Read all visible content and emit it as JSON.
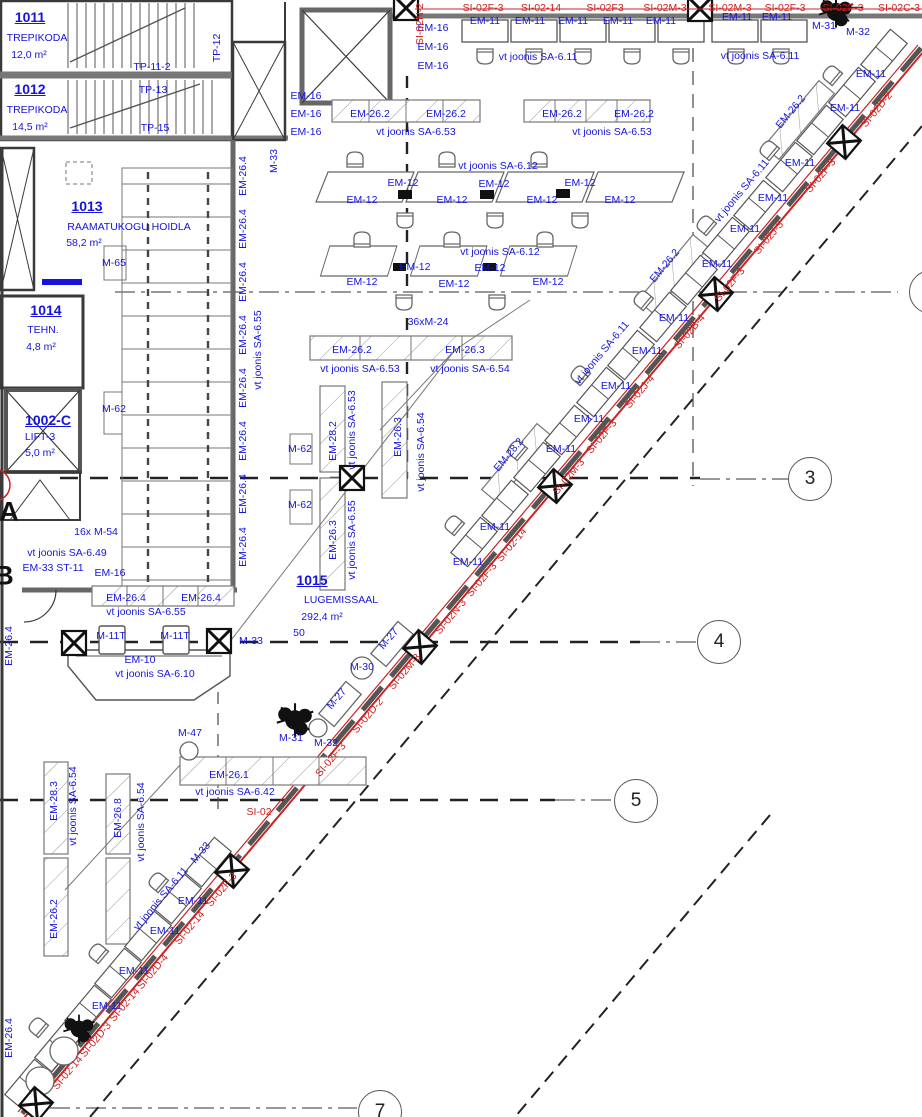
{
  "colors": {
    "label_blue": "#1414dd",
    "annotation_red": "#cc2222",
    "wall_dark": "#3a3a3a",
    "furniture_grey": "#666"
  },
  "grid": {
    "bubbles": [
      {
        "label": "3",
        "x": 810,
        "y": 479
      },
      {
        "label": "4",
        "x": 719,
        "y": 642
      },
      {
        "label": "5",
        "x": 636,
        "y": 801
      },
      {
        "label": "7",
        "x": 380,
        "y": 1112
      },
      {
        "label": "",
        "x": 931,
        "y": 292
      }
    ],
    "letters": [
      {
        "label": "A",
        "x": 9,
        "y": 512
      },
      {
        "label": "B",
        "x": 4,
        "y": 576
      }
    ]
  },
  "labels": [
    {
      "t": "1011",
      "x": 30,
      "y": 17,
      "s": 14,
      "b": 1,
      "u": 1,
      "name": "room-number-1011"
    },
    {
      "t": "TREPIKODA",
      "x": 37,
      "y": 38,
      "name": "room-name-1011"
    },
    {
      "t": "12,0 m²",
      "x": 29,
      "y": 55
    },
    {
      "t": "1012",
      "x": 30,
      "y": 89,
      "s": 14,
      "b": 1,
      "u": 1,
      "name": "room-number-1012"
    },
    {
      "t": "TREPIKODA",
      "x": 37,
      "y": 110,
      "name": "room-name-1012"
    },
    {
      "t": "14,5 m²",
      "x": 30,
      "y": 127
    },
    {
      "t": "TP-11-2",
      "x": 152,
      "y": 67
    },
    {
      "t": "TP-13",
      "x": 153,
      "y": 90
    },
    {
      "t": "TP-15",
      "x": 155,
      "y": 128
    },
    {
      "t": "TP-12",
      "x": 217,
      "y": 48,
      "r": -90
    },
    {
      "t": "M-33",
      "x": 274,
      "y": 161,
      "r": -90
    },
    {
      "t": "1013",
      "x": 87,
      "y": 206,
      "s": 14,
      "b": 1,
      "u": 1,
      "name": "room-number-1013"
    },
    {
      "t": "RAAMATUKOGU HOIDLA",
      "x": 129,
      "y": 227,
      "name": "room-name-1013"
    },
    {
      "t": "58,2 m²",
      "x": 84,
      "y": 243
    },
    {
      "t": "1014",
      "x": 46,
      "y": 310,
      "s": 14,
      "b": 1,
      "u": 1,
      "name": "room-number-1014"
    },
    {
      "t": "TEHN.",
      "x": 43,
      "y": 330,
      "name": "room-name-1014"
    },
    {
      "t": "4,8 m²",
      "x": 41,
      "y": 347
    },
    {
      "t": "1002-C",
      "x": 48,
      "y": 420,
      "s": 14,
      "b": 1,
      "u": 1,
      "name": "room-number-1002c"
    },
    {
      "t": "LIFT-3",
      "x": 40,
      "y": 437,
      "name": "room-name-1002c"
    },
    {
      "t": "5,0 m²",
      "x": 40,
      "y": 453
    },
    {
      "t": "1015",
      "x": 312,
      "y": 580,
      "s": 14,
      "b": 1,
      "u": 1,
      "name": "room-number-1015"
    },
    {
      "t": "LUGEMISSAAL",
      "x": 341,
      "y": 600,
      "name": "room-name-1015"
    },
    {
      "t": "292,4 m²",
      "x": 322,
      "y": 617
    },
    {
      "t": "50",
      "x": 299,
      "y": 633
    },
    {
      "t": "EM-16",
      "x": 433,
      "y": 28
    },
    {
      "t": "EM-16",
      "x": 433,
      "y": 47
    },
    {
      "t": "EM-16",
      "x": 433,
      "y": 66
    },
    {
      "t": "EM-16",
      "x": 306,
      "y": 96
    },
    {
      "t": "EM-16",
      "x": 306,
      "y": 114
    },
    {
      "t": "EM-16",
      "x": 306,
      "y": 132
    },
    {
      "t": "EM-26.2",
      "x": 370,
      "y": 114
    },
    {
      "t": "EM-26.2",
      "x": 446,
      "y": 114
    },
    {
      "t": "vt joonis SA-6.53",
      "x": 416,
      "y": 132
    },
    {
      "t": "EM-26.2",
      "x": 562,
      "y": 114
    },
    {
      "t": "EM-26.2",
      "x": 634,
      "y": 114
    },
    {
      "t": "vt joonis SA-6.53",
      "x": 612,
      "y": 132
    },
    {
      "t": "EM-11",
      "x": 485,
      "y": 21
    },
    {
      "t": "EM-11",
      "x": 530,
      "y": 21
    },
    {
      "t": "EM-11",
      "x": 573,
      "y": 21
    },
    {
      "t": "EM-11",
      "x": 618,
      "y": 21
    },
    {
      "t": "EM-11",
      "x": 661,
      "y": 21
    },
    {
      "t": "EM-11",
      "x": 737,
      "y": 17
    },
    {
      "t": "EM-11",
      "x": 777,
      "y": 17
    },
    {
      "t": "vt joonis SA-6.11",
      "x": 538,
      "y": 57
    },
    {
      "t": "vt joonis SA-6.11",
      "x": 760,
      "y": 56
    },
    {
      "t": "M-31",
      "x": 824,
      "y": 26
    },
    {
      "t": "M-32",
      "x": 858,
      "y": 32
    },
    {
      "t": "SI-02F-3",
      "x": 483,
      "y": 8,
      "c": "red"
    },
    {
      "t": "SI-02-14",
      "x": 541,
      "y": 8,
      "c": "red"
    },
    {
      "t": "SI-02F3",
      "x": 605,
      "y": 8,
      "c": "red"
    },
    {
      "t": "SI-02M-3",
      "x": 665,
      "y": 8,
      "c": "red"
    },
    {
      "t": "SI-02M-3",
      "x": 730,
      "y": 8,
      "c": "red"
    },
    {
      "t": "SI-02F-3",
      "x": 785,
      "y": 8,
      "c": "red"
    },
    {
      "t": "SI-02F-3",
      "x": 843,
      "y": 8,
      "c": "red",
      "k": 1
    },
    {
      "t": "SI-02C-3",
      "x": 899,
      "y": 8,
      "c": "red"
    },
    {
      "t": "SI-02N-2",
      "x": 420,
      "y": 24,
      "c": "red",
      "r": -90
    },
    {
      "t": "vt joonis SA-6.12",
      "x": 498,
      "y": 166
    },
    {
      "t": "EM-12",
      "x": 362,
      "y": 200
    },
    {
      "t": "EM-12",
      "x": 403,
      "y": 183
    },
    {
      "t": "EM-12",
      "x": 452,
      "y": 200
    },
    {
      "t": "EM-12",
      "x": 494,
      "y": 184
    },
    {
      "t": "EM-12",
      "x": 542,
      "y": 200
    },
    {
      "t": "EM-12",
      "x": 580,
      "y": 183
    },
    {
      "t": "EM-12",
      "x": 620,
      "y": 200
    },
    {
      "t": "vt joonis SA-6.12",
      "x": 500,
      "y": 252
    },
    {
      "t": "EM-12",
      "x": 362,
      "y": 282
    },
    {
      "t": "EM-12",
      "x": 415,
      "y": 267
    },
    {
      "t": "EM-12",
      "x": 454,
      "y": 284
    },
    {
      "t": "EM-12",
      "x": 490,
      "y": 268
    },
    {
      "t": "EM-12",
      "x": 548,
      "y": 282
    },
    {
      "t": "36xM-24",
      "x": 428,
      "y": 322
    },
    {
      "t": "EM-26.2",
      "x": 352,
      "y": 350
    },
    {
      "t": "EM-26.3",
      "x": 465,
      "y": 350
    },
    {
      "t": "vt joonis SA-6.53",
      "x": 360,
      "y": 369
    },
    {
      "t": "vt joonis SA-6.54",
      "x": 470,
      "y": 369
    },
    {
      "t": "EM-28.2",
      "x": 333,
      "y": 441,
      "r": -90
    },
    {
      "t": "vt joonis SA-6.53",
      "x": 352,
      "y": 430,
      "r": -90
    },
    {
      "t": "EM-26.3",
      "x": 333,
      "y": 540,
      "r": -90
    },
    {
      "t": "vt joonis SA-6.55",
      "x": 352,
      "y": 540,
      "r": -90
    },
    {
      "t": "EM-26.3",
      "x": 398,
      "y": 437,
      "r": -90
    },
    {
      "t": "vt joonis SA-6.54",
      "x": 421,
      "y": 452,
      "r": -90
    },
    {
      "t": "M-65",
      "x": 114,
      "y": 263
    },
    {
      "t": "M-62",
      "x": 114,
      "y": 409
    },
    {
      "t": "M-62",
      "x": 300,
      "y": 449
    },
    {
      "t": "M-62",
      "x": 300,
      "y": 505
    },
    {
      "t": "EM-26.4",
      "x": 243,
      "y": 176,
      "r": -90
    },
    {
      "t": "EM-26.4",
      "x": 243,
      "y": 229,
      "r": -90
    },
    {
      "t": "EM-26.4",
      "x": 243,
      "y": 282,
      "r": -90
    },
    {
      "t": "EM-26.4",
      "x": 243,
      "y": 335,
      "r": -90
    },
    {
      "t": "EM-26.4",
      "x": 243,
      "y": 388,
      "r": -90
    },
    {
      "t": "EM-26.4",
      "x": 243,
      "y": 441,
      "r": -90
    },
    {
      "t": "EM-26.4",
      "x": 243,
      "y": 494,
      "r": -90
    },
    {
      "t": "EM-26.4",
      "x": 243,
      "y": 547,
      "r": -90
    },
    {
      "t": "vt joonis SA-6.55",
      "x": 258,
      "y": 350,
      "r": -90
    },
    {
      "t": "EM-26.4",
      "x": 9,
      "y": 646,
      "r": -90
    },
    {
      "t": "EM-26.4",
      "x": 9,
      "y": 1038,
      "r": -90
    },
    {
      "t": "16x M-54",
      "x": 96,
      "y": 532
    },
    {
      "t": "vt joonis SA-6.49",
      "x": 67,
      "y": 553
    },
    {
      "t": "EM-33 ST-11",
      "x": 53,
      "y": 568
    },
    {
      "t": "EM-16",
      "x": 110,
      "y": 573
    },
    {
      "t": "EM-26.4",
      "x": 126,
      "y": 598
    },
    {
      "t": "EM-26.4",
      "x": 201,
      "y": 598
    },
    {
      "t": "vt joonis SA-6.55",
      "x": 146,
      "y": 612
    },
    {
      "t": "M-11T",
      "x": 111,
      "y": 636
    },
    {
      "t": "M-11T",
      "x": 175,
      "y": 636
    },
    {
      "t": "M-33",
      "x": 251,
      "y": 641
    },
    {
      "t": "EM-10",
      "x": 140,
      "y": 660
    },
    {
      "t": "vt joonis SA-6.10",
      "x": 155,
      "y": 674
    },
    {
      "t": "M-27",
      "x": 389,
      "y": 639,
      "r": -50
    },
    {
      "t": "M-27",
      "x": 337,
      "y": 699,
      "r": -50
    },
    {
      "t": "M-30",
      "x": 362,
      "y": 667
    },
    {
      "t": "M-31",
      "x": 291,
      "y": 738
    },
    {
      "t": "M-32",
      "x": 326,
      "y": 743
    },
    {
      "t": "M-47",
      "x": 190,
      "y": 733
    },
    {
      "t": "EM-26.1",
      "x": 229,
      "y": 775
    },
    {
      "t": "vt joonis SA-6.42",
      "x": 235,
      "y": 792
    },
    {
      "t": "SI-02",
      "x": 259,
      "y": 812,
      "c": "red"
    },
    {
      "t": "EM-28.3",
      "x": 54,
      "y": 801,
      "r": -90
    },
    {
      "t": "vt joonis SA-6.54",
      "x": 73,
      "y": 806,
      "r": -90
    },
    {
      "t": "EM-26.8",
      "x": 118,
      "y": 818,
      "r": -90
    },
    {
      "t": "vt joonis SA-6.54",
      "x": 141,
      "y": 822,
      "r": -90
    },
    {
      "t": "EM-26.2",
      "x": 54,
      "y": 919,
      "r": -90
    },
    {
      "t": "M-33",
      "x": 201,
      "y": 853,
      "r": -50
    },
    {
      "t": "EM-11",
      "x": 871,
      "y": 74
    },
    {
      "t": "EM-11",
      "x": 845,
      "y": 108
    },
    {
      "t": "EM-11",
      "x": 800,
      "y": 163
    },
    {
      "t": "EM-11",
      "x": 773,
      "y": 198
    },
    {
      "t": "EM-11",
      "x": 745,
      "y": 229
    },
    {
      "t": "EM-11",
      "x": 717,
      "y": 264
    },
    {
      "t": "EM-11",
      "x": 674,
      "y": 318
    },
    {
      "t": "EM-11",
      "x": 647,
      "y": 351
    },
    {
      "t": "EM-11",
      "x": 616,
      "y": 386
    },
    {
      "t": "EM-11",
      "x": 589,
      "y": 419
    },
    {
      "t": "EM-11",
      "x": 561,
      "y": 449
    },
    {
      "t": "EM-11",
      "x": 495,
      "y": 527
    },
    {
      "t": "EM-11",
      "x": 468,
      "y": 562
    },
    {
      "t": "EM-11",
      "x": 193,
      "y": 901
    },
    {
      "t": "EM-11",
      "x": 165,
      "y": 931
    },
    {
      "t": "EM-11",
      "x": 134,
      "y": 971
    },
    {
      "t": "EM-11",
      "x": 107,
      "y": 1006
    },
    {
      "t": "vt joonis SA-6.11",
      "x": 742,
      "y": 191,
      "r": -50
    },
    {
      "t": "vt joonis SA-6.11",
      "x": 602,
      "y": 353,
      "r": -50
    },
    {
      "t": "vt joonis SA-6.11",
      "x": 161,
      "y": 899,
      "r": -50
    },
    {
      "t": "EM-26.2",
      "x": 791,
      "y": 112,
      "r": -50
    },
    {
      "t": "EM-26.2",
      "x": 665,
      "y": 266,
      "r": -50
    },
    {
      "t": "EM-28.2",
      "x": 509,
      "y": 455,
      "r": -50
    },
    {
      "t": "SI-02D-2",
      "x": 877,
      "y": 110,
      "c": "red",
      "r": -50
    },
    {
      "t": "SI-02F-3",
      "x": 821,
      "y": 176,
      "c": "red",
      "r": -50
    },
    {
      "t": "SI-02J-3",
      "x": 769,
      "y": 238,
      "c": "red",
      "r": -50
    },
    {
      "t": "SI-02F-3",
      "x": 730,
      "y": 285,
      "c": "red",
      "r": -50
    },
    {
      "t": "SI-02B-4",
      "x": 690,
      "y": 332,
      "c": "red",
      "r": -50
    },
    {
      "t": "SI-02J-4",
      "x": 640,
      "y": 392,
      "c": "red",
      "r": -50
    },
    {
      "t": "SI-02F-3",
      "x": 602,
      "y": 437,
      "c": "red",
      "r": -50
    },
    {
      "t": "SI-02M-3",
      "x": 569,
      "y": 477,
      "c": "red",
      "r": -50
    },
    {
      "t": "SI-02-14",
      "x": 512,
      "y": 545,
      "c": "red",
      "r": -50
    },
    {
      "t": "SI-02F-3",
      "x": 482,
      "y": 580,
      "c": "red",
      "r": -50
    },
    {
      "t": "SI-02N-3",
      "x": 451,
      "y": 617,
      "c": "red",
      "r": -50
    },
    {
      "t": "SI-02M-3",
      "x": 405,
      "y": 672,
      "c": "red",
      "r": -50
    },
    {
      "t": "SI-02D-2",
      "x": 368,
      "y": 716,
      "c": "red",
      "r": -50
    },
    {
      "t": "SI-02F-3",
      "x": 331,
      "y": 760,
      "c": "red",
      "r": -50
    },
    {
      "t": "SI-02F-3",
      "x": 222,
      "y": 890,
      "c": "red",
      "r": -50
    },
    {
      "t": "SI-02-14",
      "x": 190,
      "y": 928,
      "c": "red",
      "r": -50
    },
    {
      "t": "SI-02D-4",
      "x": 153,
      "y": 972,
      "c": "red",
      "r": -50
    },
    {
      "t": "SI-02-14",
      "x": 125,
      "y": 1005,
      "c": "red",
      "r": -50
    },
    {
      "t": "SI-02D-3",
      "x": 96,
      "y": 1040,
      "c": "red",
      "r": -50
    },
    {
      "t": "SI-02-14",
      "x": 68,
      "y": 1073,
      "c": "red",
      "r": -50
    }
  ]
}
